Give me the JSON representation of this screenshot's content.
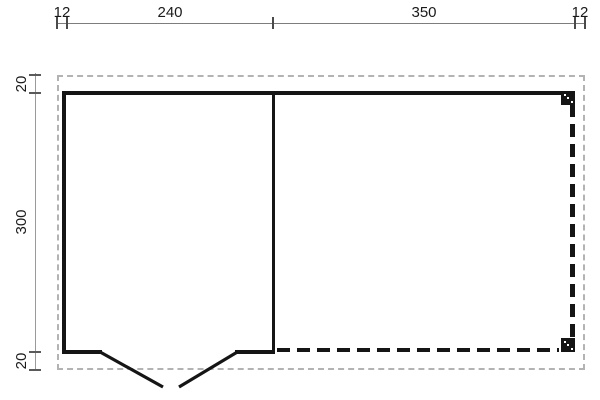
{
  "plan": {
    "type": "floor-plan",
    "dimensions": {
      "top": [
        "12",
        "240",
        "350",
        "12"
      ],
      "left": [
        "20",
        "300",
        "20"
      ]
    },
    "colors": {
      "wall": "#151515",
      "canopy_dash": "#151515",
      "roof_outline_dash": "#b3b3b3",
      "dimension_line": "#7d7d7d",
      "dimension_tick": "#4a4a4a",
      "label_text": "#1a1a1a",
      "background": "#ffffff"
    }
  }
}
